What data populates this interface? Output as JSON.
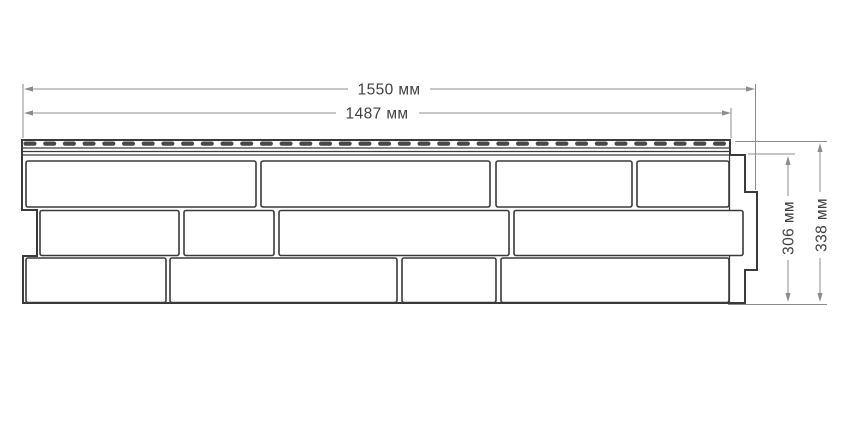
{
  "diagram": {
    "type": "technical-drawing",
    "subject": "facade-siding-panel-brick-pattern",
    "dimensions": {
      "total_length_label": "1550 мм",
      "nail_strip_length_label": "1487 мм",
      "body_height_label": "306 мм",
      "total_height_label": "338 мм"
    },
    "colors": {
      "background": "#ffffff",
      "outline": "#3a3a3a",
      "dimension_line": "#8c8c8c",
      "label_text": "#3f3f3f",
      "slot_fill": "#474747"
    },
    "nail_strip": {
      "slot_count": 36,
      "slot_start_x": 23.5,
      "slot_pitch": 19.7,
      "slot_y": 141.5,
      "slot_width": 13,
      "slot_height": 4.2,
      "slot_radius": 2.1
    },
    "bricks": [
      {
        "row": 1,
        "x": 26,
        "y": 161,
        "w": 230,
        "h": 46
      },
      {
        "row": 1,
        "x": 261,
        "y": 161,
        "w": 229,
        "h": 46
      },
      {
        "row": 1,
        "x": 496,
        "y": 161,
        "w": 136,
        "h": 46
      },
      {
        "row": 1,
        "x": 637,
        "y": 161,
        "w": 92,
        "h": 46
      },
      {
        "row": 2,
        "x": 40,
        "y": 210.5,
        "w": 139,
        "h": 45
      },
      {
        "row": 2,
        "x": 184,
        "y": 210.5,
        "w": 90,
        "h": 45
      },
      {
        "row": 2,
        "x": 279,
        "y": 210.5,
        "w": 230,
        "h": 45
      },
      {
        "row": 2,
        "x": 514,
        "y": 210.5,
        "w": 229,
        "h": 45
      },
      {
        "row": 3,
        "x": 26,
        "y": 258,
        "w": 140,
        "h": 44.5
      },
      {
        "row": 3,
        "x": 170,
        "y": 258,
        "w": 227,
        "h": 44.5
      },
      {
        "row": 3,
        "x": 402,
        "y": 258,
        "w": 94,
        "h": 44.5
      },
      {
        "row": 3,
        "x": 501,
        "y": 258,
        "w": 228,
        "h": 44.5
      }
    ]
  }
}
